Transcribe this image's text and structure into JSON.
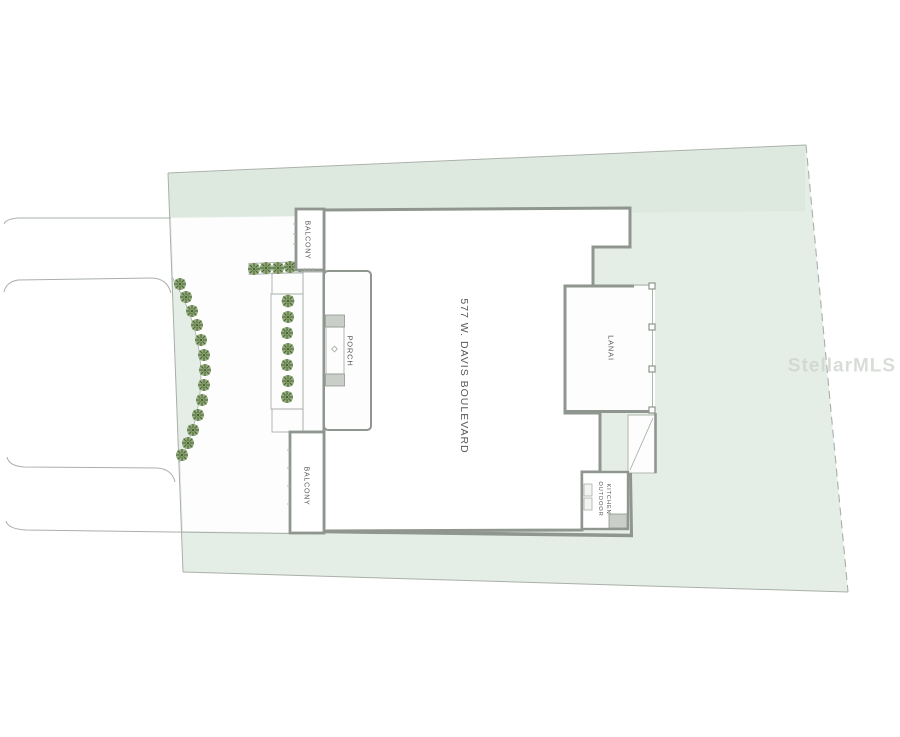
{
  "plan": {
    "address_label": "577 W. DAVIS BOULEVARD",
    "rooms": {
      "balcony_upper": "BALCONY",
      "balcony_lower": "BALCONY",
      "porch": "PORCH",
      "lanai": "LANAI",
      "outdoor_kitchen_line1": "OUTDOOR",
      "outdoor_kitchen_line2": "KITCHEN"
    },
    "watermark": "StellarMLS",
    "colors": {
      "paper": "#ffffff",
      "lot_fill": "#e4ede6",
      "lot_band": "#d9e6dc",
      "wall": "#8f968f",
      "thin_line": "#a9b0a8",
      "tree_foliage": "#92aa7d",
      "tree_dark": "#4a642f",
      "label_text": "#565b56",
      "watermark_gray": "#ccd2cc"
    }
  }
}
